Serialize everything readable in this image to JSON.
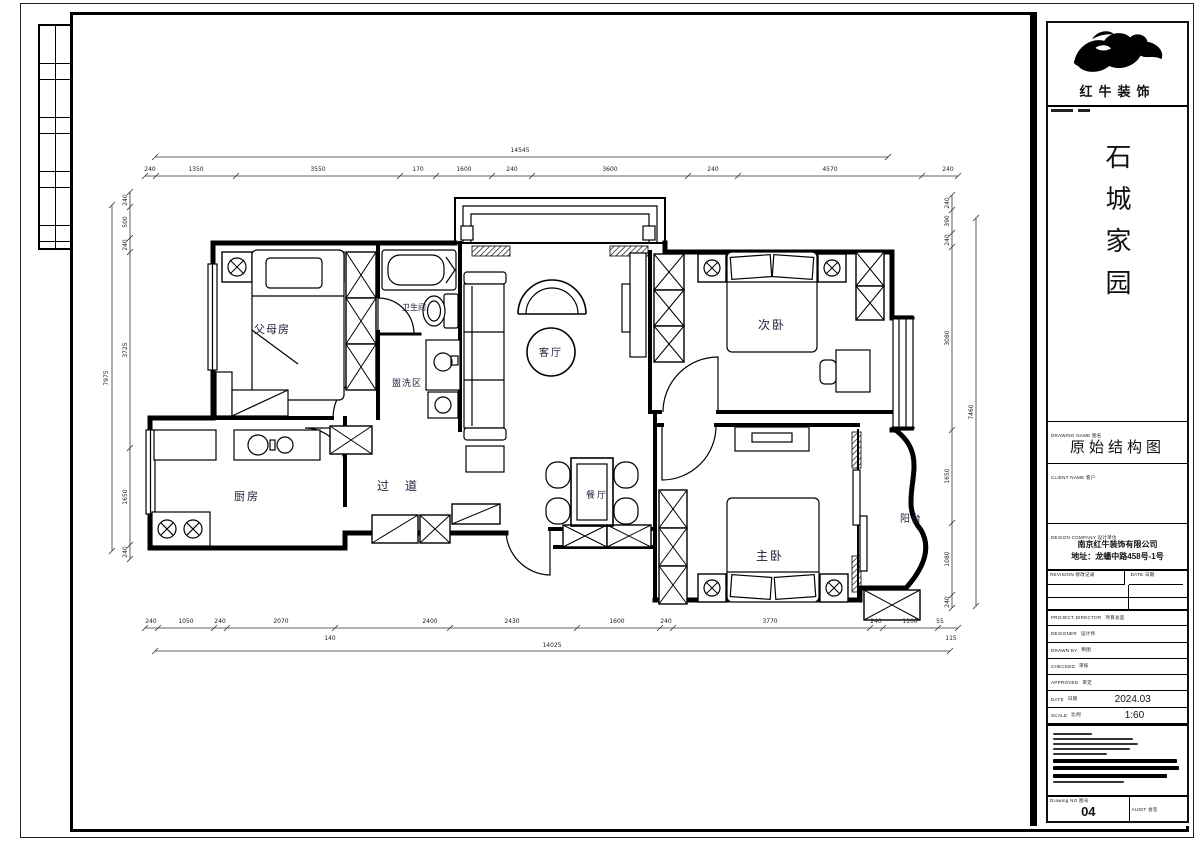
{
  "title_block": {
    "brand": "红牛装饰",
    "project": "石城家园",
    "drawing_name": "原始结构图",
    "company": "南京红牛装饰有限公司",
    "address": "地址：龙蟠中路458号-1号",
    "labels": {
      "drawing_name": "DRAWING NAME 图名",
      "client": "CLIENT NAME 客户",
      "company": "DESIGN COMPANY 设计单位",
      "rev": "REVISION 修改记录",
      "rev_date": "DATE 日期",
      "drawing_no": "Drawing NO 图号",
      "audit": "AUDIT 会签"
    },
    "rows": [
      {
        "en": "PROJECT DIRECTOR",
        "cn": "项目总监",
        "value": ""
      },
      {
        "en": "DESIGNER",
        "cn": "设计师",
        "value": ""
      },
      {
        "en": "DRAWN BY",
        "cn": "制图",
        "value": ""
      },
      {
        "en": "CHECKED",
        "cn": "审核",
        "value": ""
      },
      {
        "en": "APPROVED",
        "cn": "审定",
        "value": ""
      },
      {
        "en": "DATE",
        "cn": "日期",
        "value": "2024.03"
      },
      {
        "en": "SCALE",
        "cn": "比例",
        "value": "1:60"
      }
    ],
    "drawing_no": "04"
  },
  "plan": {
    "rooms": [
      "父母房",
      "卫生间",
      "盥洗区",
      "客厅",
      "次卧",
      "厨房",
      "过道",
      "餐厅",
      "主卧",
      "阳台"
    ],
    "dim_labels": [
      {
        "t": "240",
        "x": 150,
        "y": 171
      },
      {
        "t": "1350",
        "x": 196,
        "y": 171
      },
      {
        "t": "3550",
        "x": 318,
        "y": 171
      },
      {
        "t": "170",
        "x": 418,
        "y": 171
      },
      {
        "t": "1600",
        "x": 464,
        "y": 171
      },
      {
        "t": "240",
        "x": 512,
        "y": 171
      },
      {
        "t": "3600",
        "x": 610,
        "y": 171
      },
      {
        "t": "240",
        "x": 713,
        "y": 171
      },
      {
        "t": "4570",
        "x": 830,
        "y": 171
      },
      {
        "t": "240",
        "x": 948,
        "y": 171
      },
      {
        "t": "14545",
        "x": 520,
        "y": 152
      },
      {
        "t": "240",
        "x": 151,
        "y": 623
      },
      {
        "t": "1050",
        "x": 186,
        "y": 623
      },
      {
        "t": "240",
        "x": 220,
        "y": 623
      },
      {
        "t": "2070",
        "x": 281,
        "y": 623
      },
      {
        "t": "2400",
        "x": 430,
        "y": 623
      },
      {
        "t": "2430",
        "x": 512,
        "y": 623
      },
      {
        "t": "1600",
        "x": 617,
        "y": 623
      },
      {
        "t": "240",
        "x": 666,
        "y": 623
      },
      {
        "t": "3770",
        "x": 770,
        "y": 623
      },
      {
        "t": "240",
        "x": 876,
        "y": 623
      },
      {
        "t": "1100",
        "x": 910,
        "y": 623
      },
      {
        "t": "55",
        "x": 940,
        "y": 623
      },
      {
        "t": "140",
        "x": 330,
        "y": 640
      },
      {
        "t": "115",
        "x": 951,
        "y": 640
      },
      {
        "t": "14025",
        "x": 552,
        "y": 647
      },
      {
        "t": "240",
        "x": 127,
        "y": 200,
        "r": 1
      },
      {
        "t": "500",
        "x": 127,
        "y": 222,
        "r": 1
      },
      {
        "t": "240",
        "x": 127,
        "y": 245,
        "r": 1
      },
      {
        "t": "3725",
        "x": 127,
        "y": 350,
        "r": 1
      },
      {
        "t": "1650",
        "x": 127,
        "y": 497,
        "r": 1
      },
      {
        "t": "240",
        "x": 127,
        "y": 552,
        "r": 1
      },
      {
        "t": "7975",
        "x": 108,
        "y": 378,
        "r": 1
      },
      {
        "t": "240",
        "x": 949,
        "y": 203,
        "r": 1
      },
      {
        "t": "390",
        "x": 949,
        "y": 221,
        "r": 1
      },
      {
        "t": "240",
        "x": 949,
        "y": 240,
        "r": 1
      },
      {
        "t": "3080",
        "x": 949,
        "y": 338,
        "r": 1
      },
      {
        "t": "1650",
        "x": 949,
        "y": 476,
        "r": 1
      },
      {
        "t": "1080",
        "x": 949,
        "y": 559,
        "r": 1
      },
      {
        "t": "240",
        "x": 949,
        "y": 602,
        "r": 1
      },
      {
        "t": "7460",
        "x": 973,
        "y": 412,
        "r": 1
      }
    ],
    "ticks": {
      "top": {
        "y": 176,
        "xs": [
          145,
          156,
          236,
          400,
          436,
          492,
          532,
          688,
          738,
          922,
          958
        ]
      },
      "bottom": {
        "y": 628,
        "xs": [
          145,
          158,
          214,
          227,
          335,
          450,
          577,
          660,
          673,
          870,
          883,
          938,
          958
        ]
      },
      "left": {
        "x": 130,
        "ys": [
          192,
          207,
          238,
          252,
          448,
          545,
          559
        ]
      },
      "right": {
        "x": 952,
        "ys": [
          195,
          210,
          233,
          247,
          430,
          523,
          595,
          608
        ]
      }
    }
  }
}
